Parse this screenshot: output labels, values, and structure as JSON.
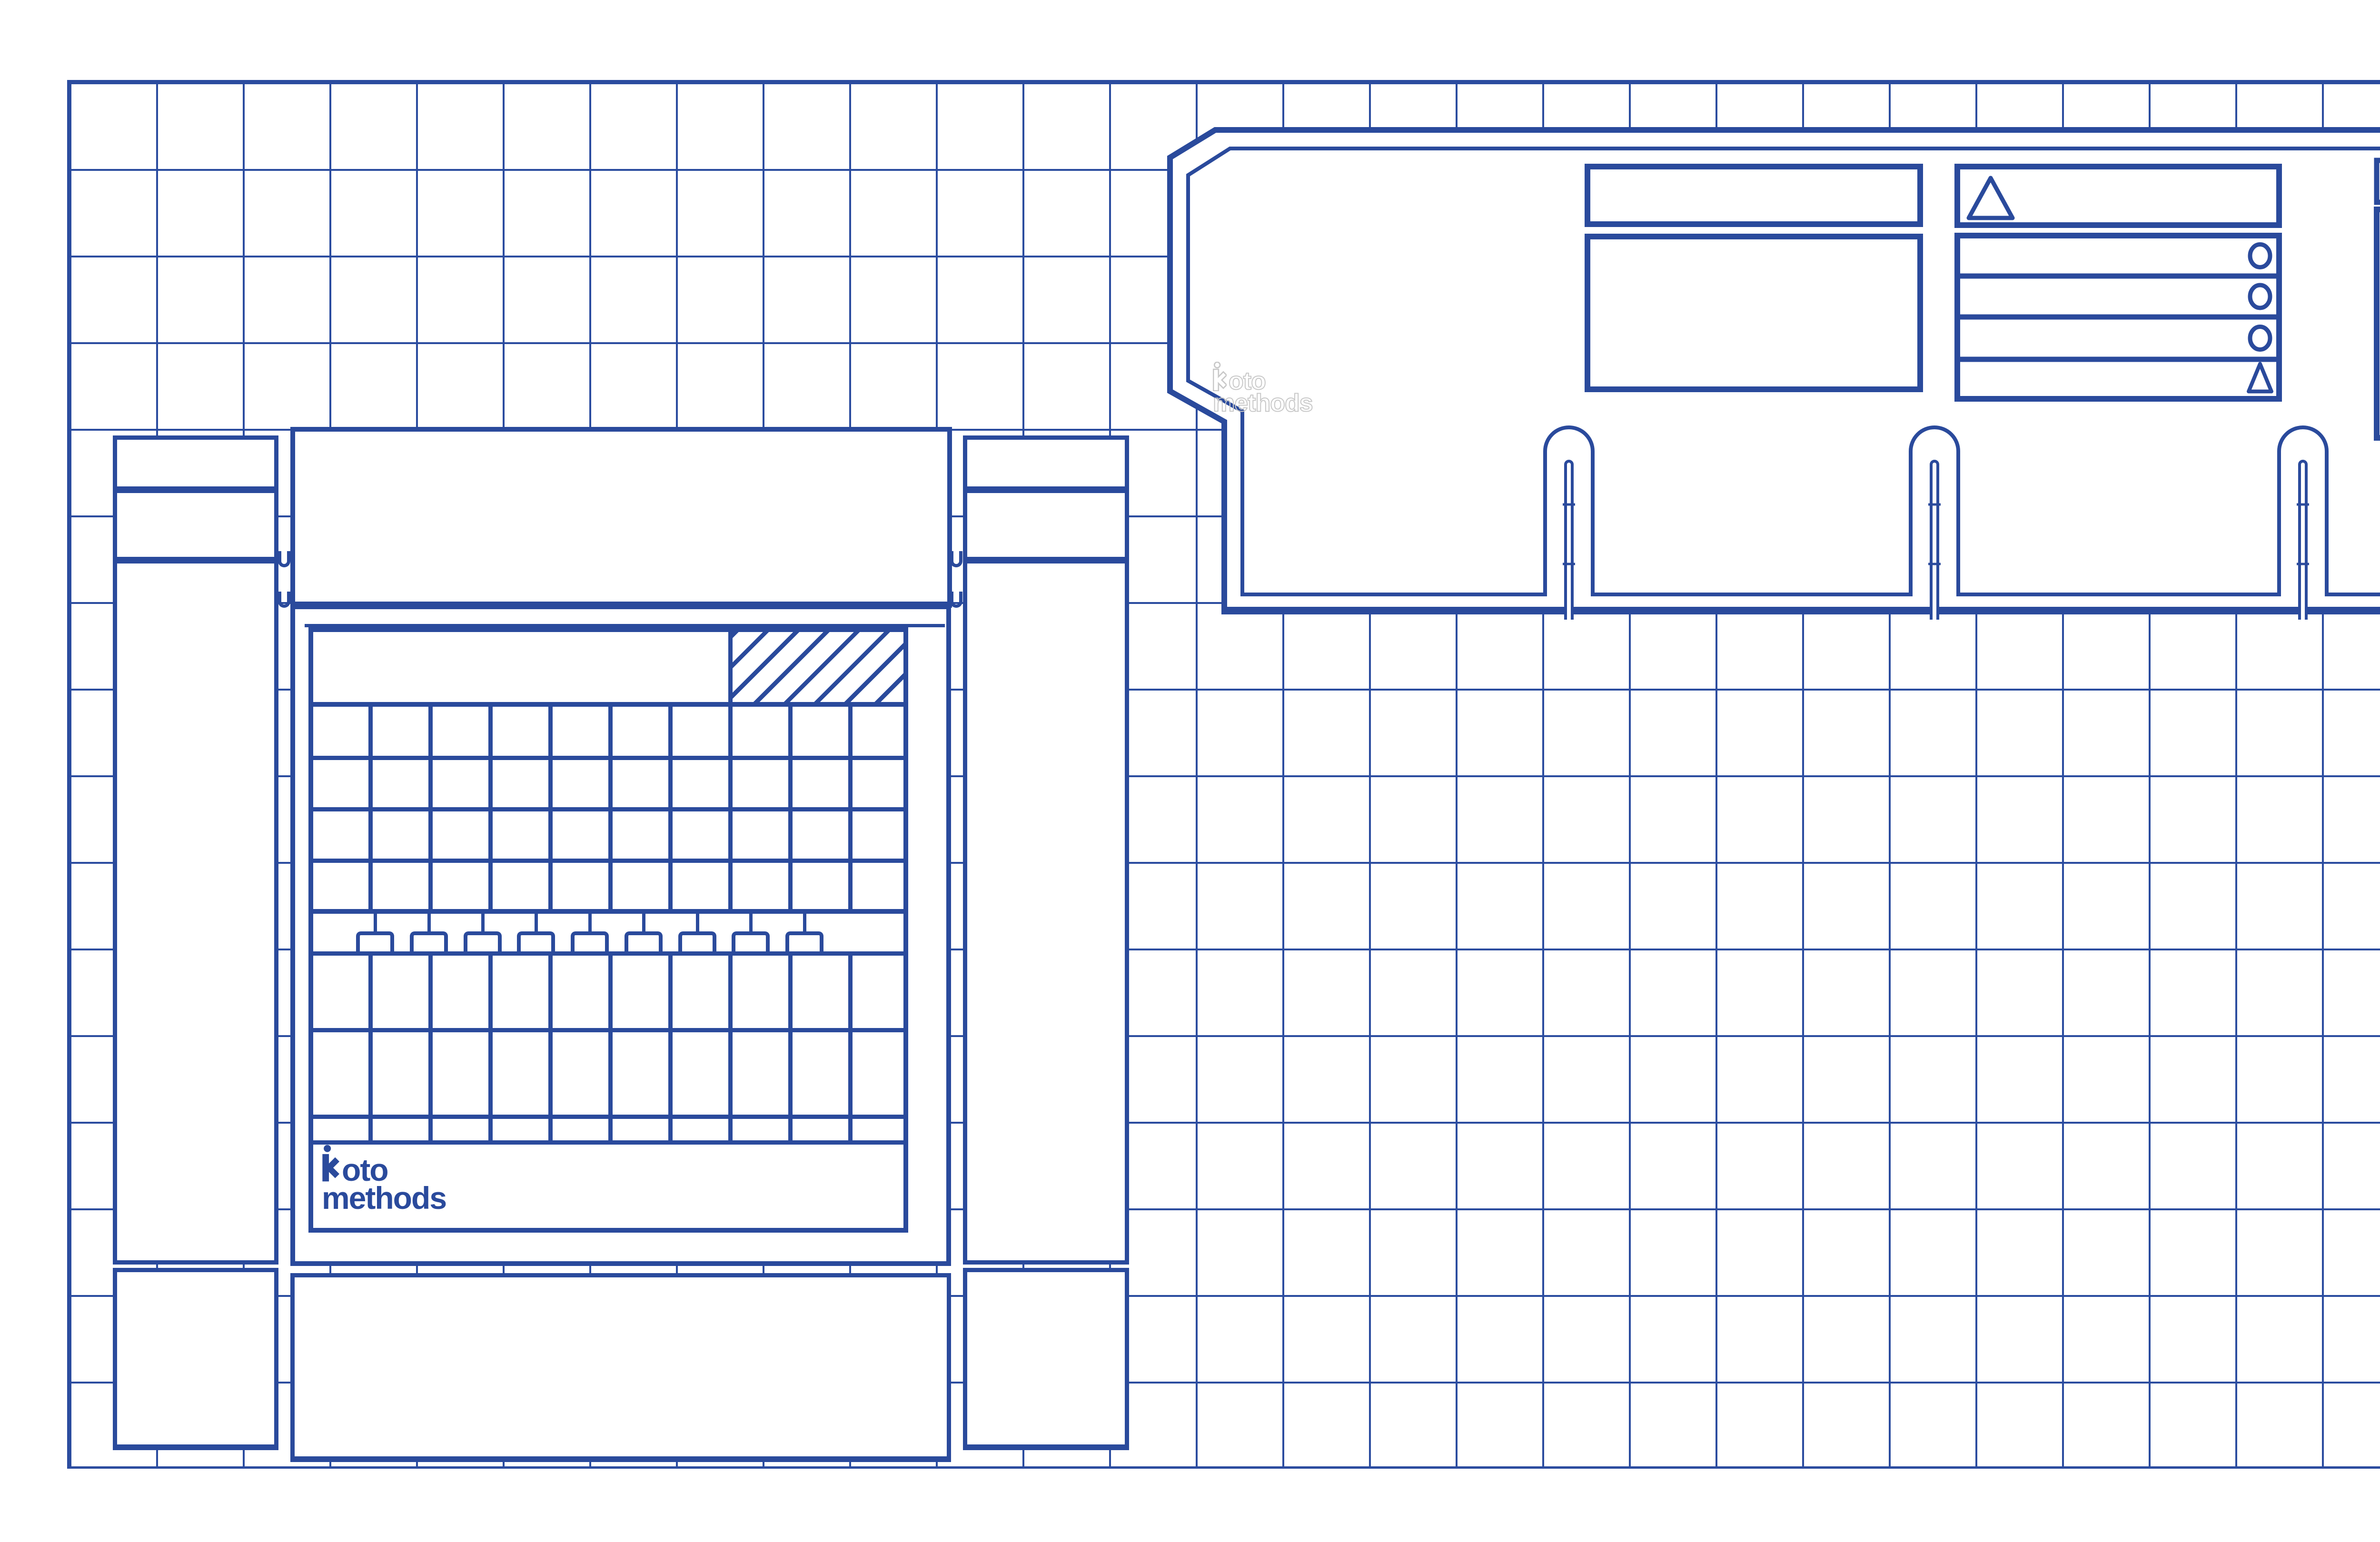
{
  "scene": "blueprint drawing of two die-cut packaging templates on a grid",
  "colors": {
    "line": "#2a4a9c",
    "grid": "#2b4c9f",
    "watermark": "#c8c8c8",
    "background": "#ffffff"
  },
  "brand": {
    "icon": "figure-person-icon",
    "logo_line1": "oto",
    "logo_line2": "methods"
  },
  "watermark": {
    "style": "outline-ghost",
    "icon": "figure-person-icon",
    "line1": "oto",
    "line2": "methods"
  },
  "left_device": {
    "type": "box die-cut template with calendar-like grid face",
    "grid": {
      "columns": 10,
      "upper_rows": 4,
      "lower_rows": 2,
      "thin_rows": 1,
      "tabs": 9,
      "hatch_area": "top-right of header band, diagonal hatch"
    }
  },
  "right_device": {
    "type": "tray die-cut template with chamfered top-left corner",
    "bottom_slots": 3,
    "panels": [
      "header-bar",
      "display-box",
      "triangle-header-box",
      "icon-list",
      "side-bar",
      "side-box"
    ],
    "triangle_header_icon": "triangle-icon",
    "list": {
      "rows": 4,
      "row_icons": [
        "circle-icon",
        "circle-icon",
        "circle-icon",
        "triangle-icon"
      ]
    }
  }
}
